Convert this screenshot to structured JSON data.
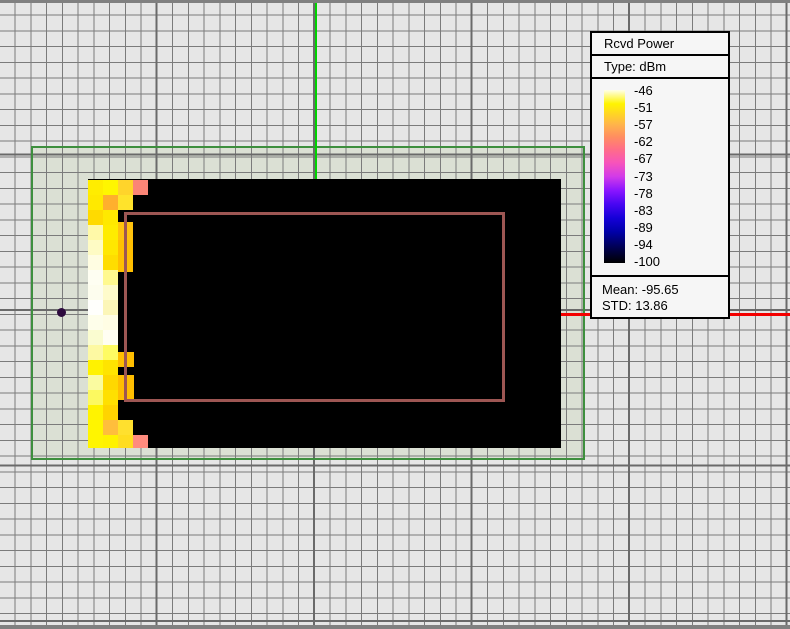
{
  "window": {
    "top_border_color": "#808080",
    "bottom_border_color": "#808080"
  },
  "canvas": {
    "background_color": "#E6E6E6",
    "grid_minor_color": "#7B7B7B",
    "grid_major_color": "#6A6A6A",
    "study_area": {
      "x": 31,
      "y": 146,
      "w": 554,
      "h": 314,
      "border_color": "#3E8F3E",
      "fill_color": "#DBE0D4"
    },
    "y_axis_color": "#00D300",
    "x_axis_color": "#F40000",
    "tx_point": {
      "x": 62,
      "y": 312,
      "color": "#2D0A3E"
    },
    "building_outline": {
      "x": 124,
      "y": 212,
      "w": 381,
      "h": 190,
      "color": "#9D5653"
    }
  },
  "legend": {
    "title": "Rcvd Power",
    "type_label": "Type: dBm",
    "scale_values": [
      "-46",
      "-51",
      "-57",
      "-62",
      "-67",
      "-73",
      "-78",
      "-83",
      "-89",
      "-94",
      "-100"
    ],
    "mean_label": "Mean: -95.65",
    "std_label": "STD: 13.86",
    "colorbar_colors": [
      "#FFFFE9",
      "#FFF400",
      "#FFB44B",
      "#FF8E60",
      "#FF6E86",
      "#F754BA",
      "#D23BE8",
      "#8B15FF",
      "#4806F2",
      "#1500D8",
      "#0000A8",
      "#000052",
      "#000000"
    ]
  },
  "chart_data": {
    "type": "heatmap",
    "title": "Rcvd Power",
    "units": "dBm",
    "scale_ticks": [
      -46,
      -51,
      -57,
      -62,
      -67,
      -73,
      -78,
      -83,
      -89,
      -94,
      -100
    ],
    "scale_range": [
      -100,
      -46
    ],
    "mean": -95.65,
    "std": 13.86,
    "legend_position": "top-right",
    "base_region": {
      "x": 88,
      "y": 179,
      "w": 473,
      "h": 269,
      "color": "#000000"
    },
    "cells": [
      [
        88,
        180,
        15,
        15,
        "#FFED00"
      ],
      [
        103,
        180,
        15,
        15,
        "#FFF600"
      ],
      [
        118,
        180,
        15,
        15,
        "#FFD42B"
      ],
      [
        133,
        180,
        15,
        15,
        "#FB8576"
      ],
      [
        88,
        195,
        15,
        15,
        "#FFE900"
      ],
      [
        103,
        195,
        15,
        15,
        "#FFAF2D"
      ],
      [
        118,
        195,
        15,
        15,
        "#FFE32B"
      ],
      [
        88,
        210,
        15,
        15,
        "#FFDA00"
      ],
      [
        103,
        210,
        15,
        15,
        "#FFE900"
      ],
      [
        88,
        225,
        15,
        15,
        "#FFF9A8"
      ],
      [
        103,
        225,
        15,
        15,
        "#FFEC00"
      ],
      [
        118,
        222,
        15,
        18,
        "#FFC30E"
      ],
      [
        88,
        240,
        15,
        15,
        "#FEFBC4"
      ],
      [
        103,
        240,
        15,
        15,
        "#FFE700"
      ],
      [
        118,
        240,
        15,
        15,
        "#FFBF00"
      ],
      [
        88,
        255,
        15,
        15,
        "#FFFDE2"
      ],
      [
        103,
        255,
        15,
        15,
        "#FFDD00"
      ],
      [
        118,
        255,
        15,
        17,
        "#FFBF00"
      ],
      [
        88,
        270,
        15,
        15,
        "#FEFEF2"
      ],
      [
        103,
        270,
        15,
        15,
        "#FFF98F"
      ],
      [
        88,
        285,
        15,
        15,
        "#FDFDEE"
      ],
      [
        103,
        285,
        15,
        15,
        "#FEFBCB"
      ],
      [
        88,
        300,
        15,
        15,
        "#FFFFFC"
      ],
      [
        103,
        300,
        15,
        15,
        "#FCF6B8"
      ],
      [
        88,
        315,
        15,
        15,
        "#FEFEEA"
      ],
      [
        103,
        315,
        15,
        15,
        "#FFFDE4"
      ],
      [
        88,
        330,
        15,
        15,
        "#FAFCD0"
      ],
      [
        103,
        330,
        15,
        15,
        "#FFFEF2"
      ],
      [
        88,
        345,
        15,
        15,
        "#FDF9A2"
      ],
      [
        103,
        345,
        15,
        15,
        "#FEFB63"
      ],
      [
        88,
        360,
        15,
        15,
        "#FFF200"
      ],
      [
        103,
        360,
        15,
        15,
        "#FFE400"
      ],
      [
        118,
        352,
        16,
        15,
        "#FFBE00"
      ],
      [
        88,
        375,
        15,
        15,
        "#FAFBA0"
      ],
      [
        103,
        375,
        15,
        15,
        "#FFD800"
      ],
      [
        118,
        375,
        16,
        15,
        "#FFBE00"
      ],
      [
        88,
        390,
        15,
        15,
        "#FCF960"
      ],
      [
        103,
        390,
        15,
        15,
        "#FFE000"
      ],
      [
        118,
        390,
        16,
        10,
        "#FFBE00"
      ],
      [
        88,
        405,
        15,
        15,
        "#FFF300"
      ],
      [
        103,
        405,
        15,
        15,
        "#FFD400"
      ],
      [
        88,
        420,
        15,
        15,
        "#FFF500"
      ],
      [
        103,
        420,
        15,
        15,
        "#FFBE3C"
      ],
      [
        118,
        420,
        15,
        15,
        "#FFE02E"
      ],
      [
        88,
        435,
        15,
        13,
        "#FFF500"
      ],
      [
        103,
        435,
        15,
        13,
        "#FFF200"
      ],
      [
        118,
        435,
        15,
        13,
        "#FFDD20"
      ],
      [
        133,
        435,
        15,
        13,
        "#FF8C7E"
      ]
    ]
  }
}
